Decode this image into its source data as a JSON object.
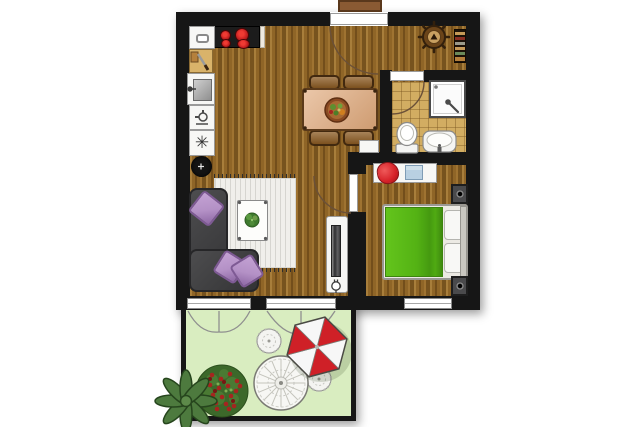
{
  "meta": {
    "title": "Apartment floor plan with terrace",
    "type": "floor-plan"
  },
  "colors": {
    "wall": "#161616",
    "wood": "#8f6527",
    "tile": "#d2ad62",
    "grass": "#d9edc0",
    "fixture_white": "#f7f7f5",
    "bed_green": "#54b214",
    "lilac": "#b491c6",
    "lilac_dark": "#7e5a94",
    "sofa": "#3e3e40",
    "sofa_border": "#262628",
    "rug": "#f0efeb",
    "table_tan": "#e0a97b",
    "table_border": "#5b3a1a",
    "chair_wood": "#8a5a22",
    "chair_wood_border": "#42290f",
    "parasol_red": "#cf2027",
    "burner_red": "#c92121",
    "bag_red": "#d62128",
    "shirt_blue": "#b9d0e2",
    "doormat": "#8a5a33",
    "doormat_border": "#5a381c",
    "plant_dark": "#3c682a",
    "plant_mid": "#4d7a3e",
    "plant_light": "#6f9c4a",
    "flower_red": "#a6251f",
    "door_arc": "#6a5038",
    "curtain_gray": "#8f8f8f"
  },
  "icons": {
    "freezer_glyph": "✳"
  },
  "rooms": [
    {
      "name": "kitchen-dining",
      "furniture": [
        "stove with 4 burners",
        "microwave oven",
        "cutting board",
        "kitchen sink",
        "dishwasher",
        "freezer",
        "dining table",
        "4 dining chairs",
        "salad bowl",
        "small cabinet"
      ]
    },
    {
      "name": "entrance-hall",
      "furniture": [
        "doormat",
        "entrance door",
        "ship wheel wall decor",
        "wall shelf"
      ]
    },
    {
      "name": "bathroom",
      "furniture": [
        "shower cabin",
        "toilet",
        "washbasin"
      ]
    },
    {
      "name": "bedroom",
      "furniture": [
        "double bed with green duvet",
        "2 pillows",
        "2 nightstands with lamps",
        "dresser with red bag and shirt",
        "window"
      ]
    },
    {
      "name": "living-room",
      "furniture": [
        "corner sofa",
        "3 lilac cushions",
        "striped area rug",
        "coffee table with plant",
        "TV sideboard",
        "round stool",
        "power outlet",
        "2 french windows"
      ]
    },
    {
      "name": "terrace",
      "furniture": [
        "round garden table",
        "2 garden chairs",
        "red-white parasol",
        "flowering bush",
        "agave plant",
        "curtains"
      ]
    }
  ]
}
